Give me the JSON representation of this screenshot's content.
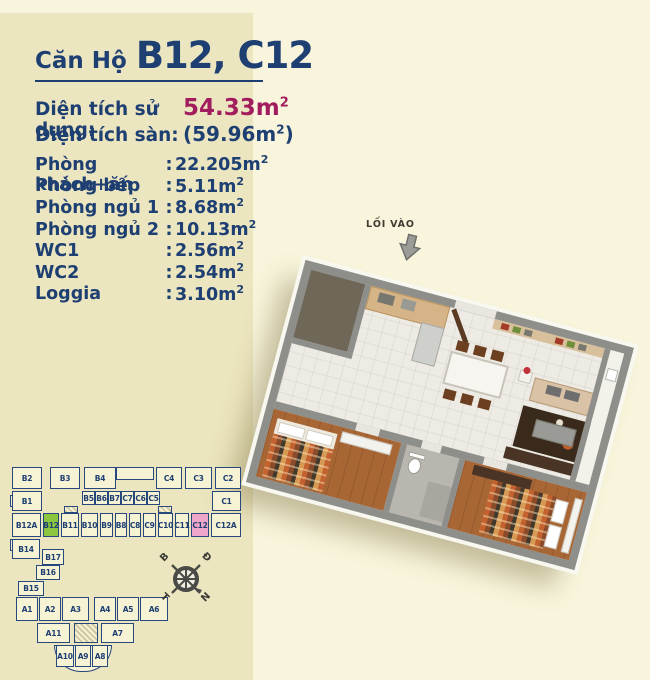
{
  "page": {
    "bg": "#f8f5dc",
    "panel_bg": "#ece6c0"
  },
  "header": {
    "title_prefix": "Căn Hộ",
    "title_main": "B12, C12",
    "accent_color": "#1e3f72"
  },
  "areas": {
    "usable": {
      "label": "Diện tích sử dụng:",
      "value": "54.33m",
      "sup": "2",
      "value_color": "#a11d5e"
    },
    "floor": {
      "label": "Diện tích sàn:",
      "value": "(59.96m",
      "sup": "2",
      "close": ")"
    }
  },
  "rooms": {
    "colon": ":",
    "sup": "2",
    "items": [
      {
        "label": "Phòng khách+ăn",
        "value": "22.205m"
      },
      {
        "label": "Phòng bếp",
        "value": "5.11m"
      },
      {
        "label": "Phòng ngủ 1",
        "value": "8.68m"
      },
      {
        "label": "Phòng ngủ 2",
        "value": "10.13m"
      },
      {
        "label": "WC1",
        "value": "2.56m"
      },
      {
        "label": "WC2",
        "value": "2.54m"
      },
      {
        "label": "Loggia",
        "value": "3.10m"
      }
    ]
  },
  "floorplan": {
    "entrance_label": "LỐI VÀO"
  },
  "building_map": {
    "fill": "#f6f2d4",
    "border": "#27487c",
    "label_color": "#1e3f72",
    "highlight_green": "#8cc63e",
    "highlight_pink": "#f0a6c8",
    "highlighted_units": [
      "B12",
      "C12"
    ],
    "units": [
      {
        "label": "B2",
        "x": 2,
        "y": 2,
        "w": 30,
        "h": 22
      },
      {
        "label": "B3",
        "x": 40,
        "y": 2,
        "w": 30,
        "h": 22
      },
      {
        "label": "B4",
        "x": 74,
        "y": 2,
        "w": 32,
        "h": 22
      },
      {
        "label": "C4",
        "x": 146,
        "y": 2,
        "w": 26,
        "h": 22
      },
      {
        "label": "C3",
        "x": 175,
        "y": 2,
        "w": 27,
        "h": 22
      },
      {
        "label": "C2",
        "x": 205,
        "y": 2,
        "w": 26,
        "h": 22
      },
      {
        "label": "B1",
        "x": 2,
        "y": 26,
        "w": 30,
        "h": 20
      },
      {
        "label": "B5",
        "x": 72,
        "y": 26,
        "w": 13,
        "h": 14
      },
      {
        "label": "B6",
        "x": 85,
        "y": 26,
        "w": 13,
        "h": 14
      },
      {
        "label": "B7",
        "x": 98,
        "y": 26,
        "w": 13,
        "h": 14
      },
      {
        "label": "C7",
        "x": 111,
        "y": 26,
        "w": 13,
        "h": 14
      },
      {
        "label": "C6",
        "x": 124,
        "y": 26,
        "w": 13,
        "h": 14
      },
      {
        "label": "C5",
        "x": 137,
        "y": 26,
        "w": 13,
        "h": 14
      },
      {
        "label": "C1",
        "x": 202,
        "y": 26,
        "w": 29,
        "h": 20
      },
      {
        "label": "B12A",
        "x": 2,
        "y": 48,
        "w": 29,
        "h": 24
      },
      {
        "label": "B12",
        "x": 33,
        "y": 48,
        "w": 16,
        "h": 24,
        "hl": "green"
      },
      {
        "label": "B11",
        "x": 51,
        "y": 48,
        "w": 18,
        "h": 24
      },
      {
        "label": "B10",
        "x": 71,
        "y": 48,
        "w": 17,
        "h": 24
      },
      {
        "label": "B9",
        "x": 90,
        "y": 48,
        "w": 13,
        "h": 24
      },
      {
        "label": "B8",
        "x": 105,
        "y": 48,
        "w": 12,
        "h": 24
      },
      {
        "label": "C8",
        "x": 119,
        "y": 48,
        "w": 12,
        "h": 24
      },
      {
        "label": "C9",
        "x": 133,
        "y": 48,
        "w": 13,
        "h": 24
      },
      {
        "label": "C10",
        "x": 148,
        "y": 48,
        "w": 15,
        "h": 24
      },
      {
        "label": "C11",
        "x": 165,
        "y": 48,
        "w": 14,
        "h": 24
      },
      {
        "label": "C12",
        "x": 181,
        "y": 48,
        "w": 18,
        "h": 24,
        "hl": "pink"
      },
      {
        "label": "C12A",
        "x": 201,
        "y": 48,
        "w": 30,
        "h": 24
      },
      {
        "label": "B14",
        "x": 2,
        "y": 74,
        "w": 28,
        "h": 20
      },
      {
        "label": "B17",
        "x": 32,
        "y": 84,
        "w": 22,
        "h": 16
      },
      {
        "label": "B16",
        "x": 26,
        "y": 100,
        "w": 24,
        "h": 15
      },
      {
        "label": "B15",
        "x": 8,
        "y": 116,
        "w": 26,
        "h": 15
      },
      {
        "label": "A1",
        "x": 6,
        "y": 132,
        "w": 22,
        "h": 24
      },
      {
        "label": "A2",
        "x": 29,
        "y": 132,
        "w": 22,
        "h": 24
      },
      {
        "label": "A3",
        "x": 52,
        "y": 132,
        "w": 27,
        "h": 24
      },
      {
        "label": "A4",
        "x": 84,
        "y": 132,
        "w": 22,
        "h": 24
      },
      {
        "label": "A5",
        "x": 107,
        "y": 132,
        "w": 22,
        "h": 24
      },
      {
        "label": "A6",
        "x": 130,
        "y": 132,
        "w": 28,
        "h": 24
      },
      {
        "label": "A11",
        "x": 27,
        "y": 158,
        "w": 33,
        "h": 20
      },
      {
        "label": "A7",
        "x": 91,
        "y": 158,
        "w": 33,
        "h": 20
      },
      {
        "label": "A10",
        "x": 46,
        "y": 180,
        "w": 18,
        "h": 22
      },
      {
        "label": "A9",
        "x": 65,
        "y": 180,
        "w": 16,
        "h": 22
      },
      {
        "label": "A8",
        "x": 82,
        "y": 180,
        "w": 16,
        "h": 22
      }
    ],
    "decor": [
      {
        "x": 106,
        "y": 2,
        "w": 38,
        "h": 13,
        "type": "plain"
      },
      {
        "x": 54,
        "y": 41,
        "w": 14,
        "h": 7,
        "type": "hatch"
      },
      {
        "x": 148,
        "y": 41,
        "w": 14,
        "h": 7,
        "type": "hatch"
      },
      {
        "x": 64,
        "y": 158,
        "w": 24,
        "h": 20,
        "type": "hatch"
      },
      {
        "x": 44,
        "y": 180,
        "w": 58,
        "h": 27,
        "type": "curve"
      },
      {
        "x": 0,
        "y": 30,
        "w": 5,
        "h": 12,
        "type": "plain"
      },
      {
        "x": 0,
        "y": 74,
        "w": 5,
        "h": 12,
        "type": "plain"
      }
    ]
  },
  "compass": {
    "top_left": "B",
    "top_right": "Đ",
    "bottom_left": "T",
    "bottom_right": "N"
  }
}
